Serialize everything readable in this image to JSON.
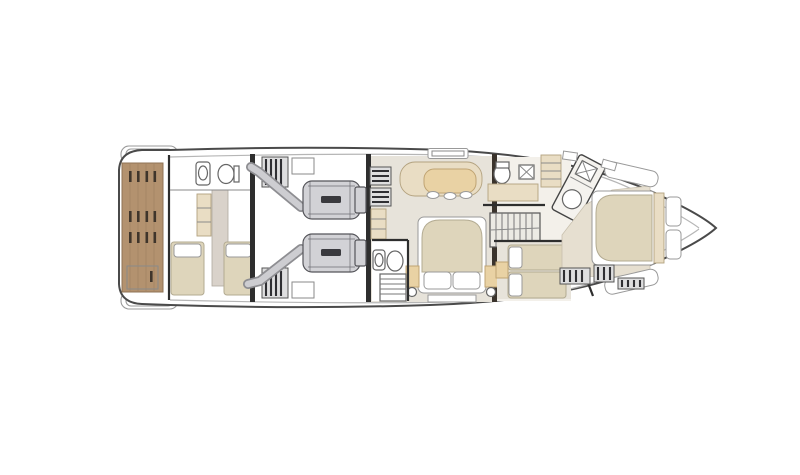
{
  "canvas": {
    "width": 800,
    "height": 475,
    "background": "#ffffff"
  },
  "diagram": {
    "type": "yacht-lower-deck-floorplan",
    "orientation": "bow-right-stern-left",
    "regions": [
      {
        "name": "swim-platform",
        "finish": "teak"
      },
      {
        "name": "crew-cabin",
        "features": [
          "wc",
          "sink",
          "two-single-beds",
          "closet"
        ]
      },
      {
        "name": "engine-room",
        "features": [
          "port-engine",
          "starboard-engine",
          "exhaust-pipes",
          "equipment-racks"
        ]
      },
      {
        "name": "companionway-steps",
        "features": [
          "two-step-stacks"
        ]
      },
      {
        "name": "master-cabin",
        "features": [
          "sofa",
          "table",
          "stools",
          "double-bed",
          "pillows",
          "nightstands",
          "lamps",
          "bench",
          "ensuite-wc",
          "ladder",
          "shelves"
        ]
      },
      {
        "name": "day-head",
        "features": [
          "wc",
          "sink",
          "mat"
        ]
      },
      {
        "name": "staircase",
        "features": [
          "treads"
        ]
      },
      {
        "name": "twin-guest-cabin",
        "features": [
          "two-single-beds",
          "nightstand"
        ]
      },
      {
        "name": "vip-bathroom",
        "features": [
          "shower-sink",
          "wc"
        ],
        "angled": true
      },
      {
        "name": "vip-cabin",
        "features": [
          "island-double-bed",
          "headboard-panels",
          "side-benches",
          "cushions",
          "vent-grilles",
          "steps"
        ]
      }
    ]
  },
  "colors": {
    "hull_line": "#4a4a4a",
    "inner_line": "#b6b6b6",
    "wall": "#2e2e2e",
    "wood_wall": "#3a332c",
    "teak": "#b3926f",
    "teak_line": "#8f7354",
    "teak_slot": "#3f352b",
    "floor": "#e7e3da",
    "floor_fore": "#f3f0ea",
    "floor_warm": "#e6dfd0",
    "beige_light": "#e9ddc4",
    "tan": "#e9d2a4",
    "mattress": "#ded5bb",
    "fixture_line": "#666666",
    "engine": "#d2d2d6",
    "engine_dark": "#55555a",
    "engine_label": "#3a3a3e",
    "pipe": "#cdcdd1",
    "pipe_edge": "#8e8e92",
    "corridor": "#d9d2ca",
    "grille": "#2f2f33"
  }
}
